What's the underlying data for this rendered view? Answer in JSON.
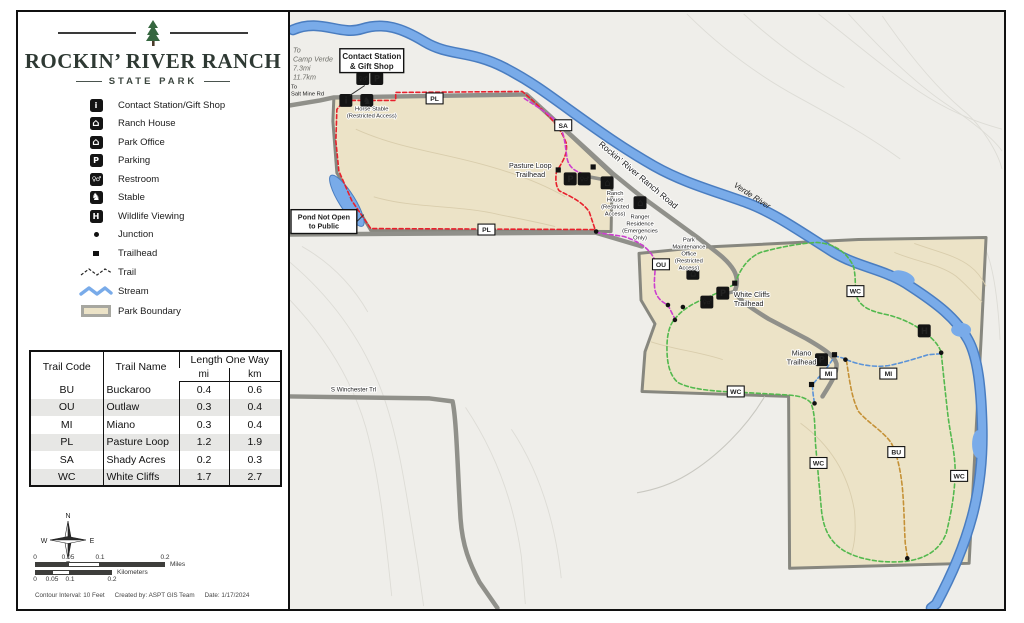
{
  "panel": {
    "park_name": "ROCKIN’ RIVER RANCH",
    "park_subtitle": "STATE PARK",
    "legend_items": [
      {
        "key": "contact-station",
        "label": "Contact Station/Gift Shop",
        "glyph": "i"
      },
      {
        "key": "ranch-house",
        "label": "Ranch House",
        "glyph": "⌂"
      },
      {
        "key": "park-office",
        "label": "Park Office",
        "glyph": "⌂"
      },
      {
        "key": "parking",
        "label": "Parking",
        "glyph": "P"
      },
      {
        "key": "restroom",
        "label": "Restroom",
        "glyph": "♀♂"
      },
      {
        "key": "stable",
        "label": "Stable",
        "glyph": "♞"
      },
      {
        "key": "wildlife-viewing",
        "label": "Wildlife Viewing",
        "glyph": "H"
      },
      {
        "key": "junction",
        "label": "Junction"
      },
      {
        "key": "trailhead",
        "label": "Trailhead"
      },
      {
        "key": "trail",
        "label": "Trail"
      },
      {
        "key": "stream",
        "label": "Stream"
      },
      {
        "key": "park-boundary",
        "label": "Park Boundary"
      }
    ],
    "table": {
      "headers": {
        "code": "Trail Code",
        "name": "Trail Name",
        "length": "Length One Way",
        "mi": "mi",
        "km": "km"
      },
      "rows": [
        {
          "code": "BU",
          "name": "Buckaroo",
          "mi": "0.4",
          "km": "0.6"
        },
        {
          "code": "OU",
          "name": "Outlaw",
          "mi": "0.3",
          "km": "0.4"
        },
        {
          "code": "MI",
          "name": "Miano",
          "mi": "0.3",
          "km": "0.4"
        },
        {
          "code": "PL",
          "name": "Pasture Loop",
          "mi": "1.2",
          "km": "1.9"
        },
        {
          "code": "SA",
          "name": "Shady Acres",
          "mi": "0.2",
          "km": "0.3"
        },
        {
          "code": "WC",
          "name": "White Cliffs",
          "mi": "1.7",
          "km": "2.7"
        }
      ]
    },
    "compass": {
      "n": "N",
      "s": "S",
      "e": "E",
      "w": "W"
    },
    "scale": {
      "miles_ticks": [
        "0",
        "0.05",
        "0.1",
        "0.2"
      ],
      "km_ticks": [
        "0",
        "0.05",
        "0.1",
        "0.2"
      ],
      "miles_label": "Miles",
      "km_label": "Kilometers"
    },
    "credits": {
      "contour": "Contour Interval: 10 Feet",
      "created": "Created by: ASPT GIS Team",
      "date": "Date: 1/17/2024"
    }
  },
  "map": {
    "labels": {
      "to_camp_verde": [
        "To",
        "Camp Verde",
        "7.3mi",
        "11.7km"
      ],
      "to_salt_mine": [
        "To",
        "Salt Mine Rd"
      ],
      "contact_station": [
        "Contact Station",
        "& Gift Shop"
      ],
      "horse_stable": [
        "Horse Stable",
        "(Restricted Access)"
      ],
      "pond": [
        "Pond Not Open",
        "to Public"
      ],
      "road_name": "Rockin’ River Ranch Road",
      "ranch_house": [
        "Ranch",
        "House",
        "(Restricted",
        "Access)"
      ],
      "ranger_residence": [
        "Ranger",
        "Residence",
        "(Emergencies",
        "Only)"
      ],
      "park_maintenance": [
        "Park",
        "Maintenance",
        "Office",
        "(Restricted",
        "Access)"
      ],
      "pasture_loop_th": [
        "Pasture Loop",
        "Trailhead"
      ],
      "white_cliffs_th": [
        "White Cliffs",
        "Trailhead"
      ],
      "miano_th": [
        "Miano",
        "Trailhead"
      ],
      "verde_river": "Verde River",
      "winchester": "S Winchester Trl"
    },
    "icon_glyphs": {
      "contact-station": "i",
      "ranch-house": "⌂",
      "park-office": "⌂",
      "parking": "P",
      "restroom": "♀♂",
      "stable": "♞",
      "wildlife-viewing": "H"
    },
    "markers": [
      {
        "code": "PL",
        "x": 435,
        "y": 97
      },
      {
        "code": "PL",
        "x": 487,
        "y": 229
      },
      {
        "code": "SA",
        "x": 564,
        "y": 124
      },
      {
        "code": "OU",
        "x": 662,
        "y": 264
      },
      {
        "code": "WC",
        "x": 857,
        "y": 291
      },
      {
        "code": "WC",
        "x": 737,
        "y": 392
      },
      {
        "code": "WC",
        "x": 820,
        "y": 464
      },
      {
        "code": "WC",
        "x": 961,
        "y": 477
      },
      {
        "code": "MI",
        "x": 830,
        "y": 374
      },
      {
        "code": "MI",
        "x": 890,
        "y": 374
      },
      {
        "code": "BU",
        "x": 898,
        "y": 453
      }
    ],
    "facilities": [
      {
        "type": "restroom",
        "x": 363,
        "y": 77
      },
      {
        "type": "parking",
        "x": 377,
        "y": 77
      },
      {
        "type": "contact-station",
        "x": 346,
        "y": 99
      },
      {
        "type": "stable",
        "x": 367,
        "y": 99
      },
      {
        "type": "parking",
        "x": 571,
        "y": 178
      },
      {
        "type": "restroom",
        "x": 585,
        "y": 178
      },
      {
        "type": "ranch-house",
        "x": 608,
        "y": 182
      },
      {
        "type": "park-office",
        "x": 641,
        "y": 202
      },
      {
        "type": "park-office",
        "x": 694,
        "y": 273
      },
      {
        "type": "parking",
        "x": 724,
        "y": 293
      },
      {
        "type": "restroom",
        "x": 708,
        "y": 302
      },
      {
        "type": "parking",
        "x": 823,
        "y": 360
      },
      {
        "type": "wildlife-viewing",
        "x": 926,
        "y": 331
      }
    ],
    "junctions": [
      [
        597,
        231
      ],
      [
        669,
        305
      ],
      [
        684,
        307
      ],
      [
        676,
        320
      ],
      [
        847,
        360
      ],
      [
        943,
        353
      ],
      [
        816,
        404
      ],
      [
        909,
        560
      ]
    ],
    "trailheads": [
      [
        559,
        169
      ],
      [
        594,
        166
      ],
      [
        736,
        283
      ],
      [
        836,
        355
      ],
      [
        813,
        385
      ]
    ],
    "colors": {
      "pasture_loop": "#e8202c",
      "shady_acres": "#cc3fcf",
      "outlaw": "#cc3fcf",
      "white_cliffs": "#53b94e",
      "miano": "#5b93d8",
      "buckaroo": "#c59136",
      "river": "#79abe9",
      "boundary_fill": "#ece3c7",
      "road": "#90908a"
    }
  }
}
